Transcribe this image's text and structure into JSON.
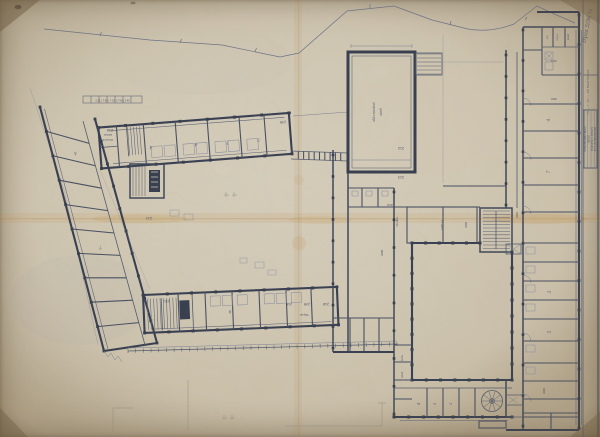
{
  "document": {
    "type": "scanned architectural floor-plan blueprint",
    "subject": "school building, second-floor plan on aged folded paper"
  },
  "annotations": {
    "handwritten_note": "Dyas 5/36 ¼",
    "margin_vertical_text": "70 — I. Qx — ZŠ BRATISLAVA",
    "dimension_chain": "3·25 | 7·50 | 7·50 | 7·50 | 2·45",
    "title_block": {
      "lines": [
        "STAVOPROJEKT BRNO",
        "ŠKOLA",
        "PÔDORYS II. POSCH.",
        "B 13-20 BRATISLAVA"
      ]
    }
  },
  "room_labels": [
    {
      "t": "236",
      "x": 110,
      "y": 129,
      "r": 180,
      "s": 3.2
    },
    {
      "t": "236",
      "x": 283,
      "y": 121,
      "r": 176,
      "s": 3.2
    },
    {
      "t": "231",
      "x": 167,
      "y": 300,
      "r": 178,
      "s": 3.2
    },
    {
      "t": "216",
      "x": 289,
      "y": 303,
      "r": 178,
      "s": 3.2
    },
    {
      "t": "239",
      "x": 307,
      "y": 303,
      "r": 178,
      "s": 3.2
    },
    {
      "t": "218",
      "x": 326,
      "y": 303,
      "r": 178,
      "s": 3.2
    },
    {
      "t": "213",
      "x": 149,
      "y": 217,
      "r": 180,
      "s": 3.2
    },
    {
      "t": "212",
      "x": 401,
      "y": 147,
      "r": 180,
      "s": 3.2
    },
    {
      "t": "213",
      "x": 401,
      "y": 176,
      "r": 180,
      "s": 3.2
    },
    {
      "t": "210",
      "x": 390,
      "y": 204,
      "r": 180,
      "s": 3
    },
    {
      "t": "209",
      "x": 467,
      "y": 225,
      "r": -90,
      "s": 3
    },
    {
      "t": "208",
      "x": 383,
      "y": 253,
      "r": -90,
      "s": 3
    },
    {
      "t": "206",
      "x": 518,
      "y": 215,
      "r": -90,
      "s": 3
    },
    {
      "t": "200",
      "x": 545,
      "y": 391,
      "r": -90,
      "s": 3
    },
    {
      "t": "263",
      "x": 554,
      "y": 60,
      "r": 180,
      "s": 3
    },
    {
      "t": "260",
      "x": 554,
      "y": 98,
      "r": 180,
      "s": 3
    },
    {
      "t": "Papier",
      "x": 304,
      "y": 314,
      "r": 180,
      "s": 2.8,
      "k": "micro"
    },
    {
      "t": "kabinet",
      "x": 108,
      "y": 134,
      "r": 180,
      "s": 2.2,
      "k": "micro"
    },
    {
      "t": "zborovňa",
      "x": 108,
      "y": 139,
      "r": 180,
      "s": 2.2,
      "k": "micro"
    },
    {
      "t": "w.c.",
      "x": 548,
      "y": 37,
      "r": -90,
      "s": 2.3,
      "k": "micro"
    },
    {
      "t": "umyv.",
      "x": 558,
      "y": 37,
      "r": -90,
      "s": 2.3,
      "k": "micro"
    },
    {
      "t": "sklad",
      "x": 569,
      "y": 37,
      "r": -90,
      "s": 2.3,
      "k": "micro"
    },
    {
      "t": "chodba",
      "x": 398,
      "y": 222,
      "r": -90,
      "s": 2.6,
      "k": "micro"
    },
    {
      "t": "1405·14",
      "x": 443,
      "y": 225,
      "r": -90,
      "s": 2.4,
      "k": "micro"
    },
    {
      "t": "šatňa",
      "x": 403,
      "y": 358,
      "r": -90,
      "s": 2.2,
      "k": "micro"
    },
    {
      "t": "sklad",
      "x": 403,
      "y": 375,
      "r": -90,
      "s": 2.2,
      "k": "micro"
    },
    {
      "t": "slávnostná",
      "x": 375,
      "y": 112,
      "r": -90,
      "s": 3.6,
      "k": "hand"
    },
    {
      "t": "sieň",
      "x": 382,
      "y": 112,
      "r": -90,
      "s": 3.6,
      "k": "hand"
    },
    {
      "t": "4",
      "x": 151,
      "y": 146,
      "r": 184,
      "s": 4.5,
      "k": "hand"
    },
    {
      "t": "4",
      "x": 196,
      "y": 143,
      "r": 184,
      "s": 4.5,
      "k": "hand"
    },
    {
      "t": "7",
      "x": 228,
      "y": 141,
      "r": 184,
      "s": 4.5,
      "k": "hand"
    },
    {
      "t": "7",
      "x": 259,
      "y": 138,
      "r": 184,
      "s": 4.5,
      "k": "hand"
    },
    {
      "t": "4",
      "x": 75,
      "y": 152,
      "r": 166,
      "s": 4.5,
      "k": "hand"
    },
    {
      "t": "7",
      "x": 100,
      "y": 246,
      "r": 166,
      "s": 4.5,
      "k": "hand"
    },
    {
      "t": "9",
      "x": 230,
      "y": 310,
      "r": 178,
      "s": 4.5,
      "k": "hand"
    },
    {
      "t": "4",
      "x": 550,
      "y": 120,
      "r": -90,
      "s": 4.2,
      "k": "hand"
    },
    {
      "t": "7",
      "x": 550,
      "y": 172,
      "r": -90,
      "s": 4.2,
      "k": "hand"
    },
    {
      "t": "3",
      "x": 551,
      "y": 292,
      "r": -90,
      "s": 4.2,
      "k": "hand"
    },
    {
      "t": "5",
      "x": 551,
      "y": 332,
      "r": -90,
      "s": 4.2,
      "k": "hand"
    },
    {
      "t": "4",
      "x": 420,
      "y": 404,
      "r": -90,
      "s": 4,
      "k": "hand"
    },
    {
      "t": "5",
      "x": 436,
      "y": 404,
      "r": -90,
      "s": 4,
      "k": "hand"
    },
    {
      "t": "3",
      "x": 452,
      "y": 404,
      "r": -90,
      "s": 4,
      "k": "hand"
    }
  ],
  "colors": {
    "paper": "#cfc6b3",
    "ink": "#3a4152",
    "ink_soft": "#6a7184",
    "stain": "#c2934e",
    "pencil": "#9a9384"
  }
}
